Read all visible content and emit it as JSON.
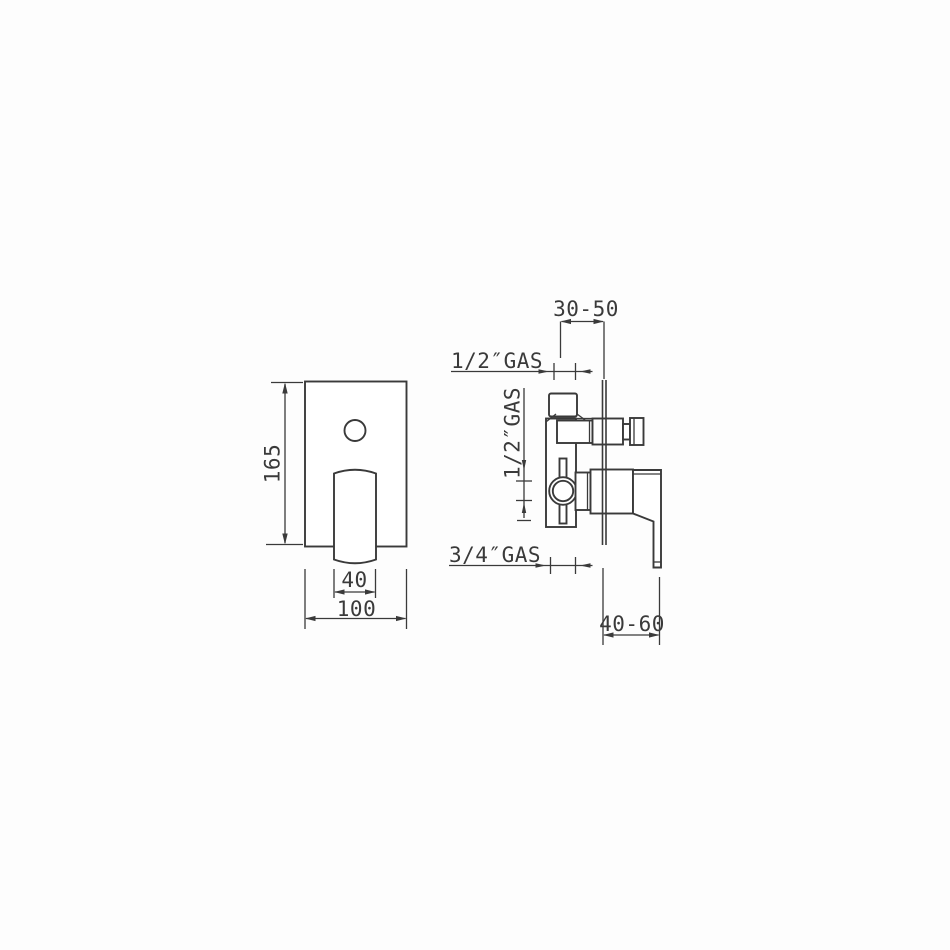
{
  "front_view": {
    "height": "165",
    "handle_width": "40",
    "plate_width": "100"
  },
  "side_view": {
    "top_depth": "30-50",
    "bottom_depth": "40-60",
    "top_outlet_thread": "1/2″GAS",
    "inlet_thread": "1/2″GAS",
    "bottom_outlet_thread": "3/4″GAS"
  },
  "colors": {
    "line": "#3a3a3a",
    "background": "#fdfdfd"
  }
}
